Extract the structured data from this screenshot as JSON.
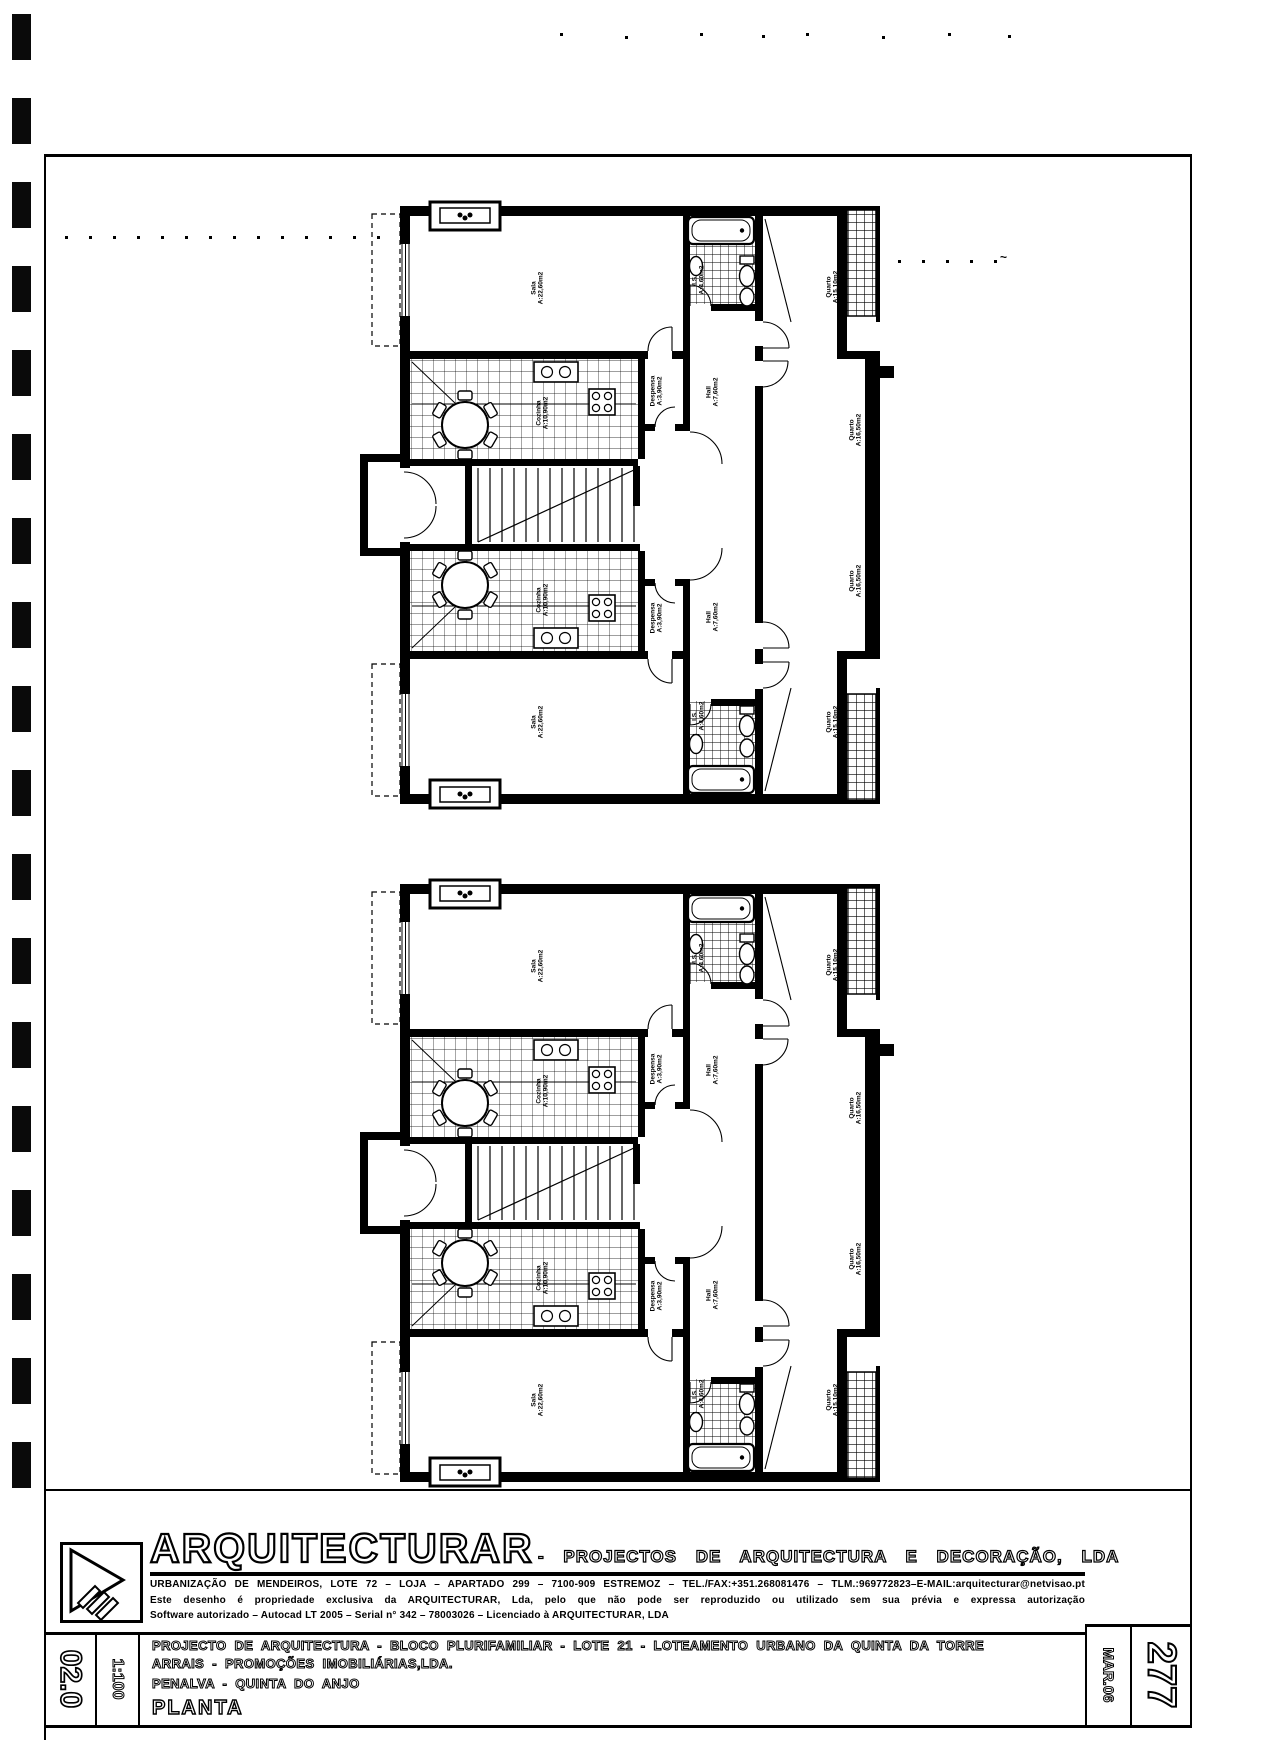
{
  "title_block": {
    "firm": "ARQUITECTURAR",
    "firm_suffix": "- PROJECTOS DE ARQUITECTURA E DECORAÇÃO, LDA",
    "address": "URBANIZAÇÃO DE MENDEIROS, LOTE 72 – LOJA – APARTADO 299 – 7100-909 ESTREMOZ – TEL./FAX:+351.268081476 – TLM.:969772823–E-MAIL:arquitecturar@netvisao.pt",
    "notice": "Este desenho é propriedade exclusiva da ARQUITECTURAR, Lda, pelo que não pode ser reproduzido ou utilizado sem sua prévia e expressa autorização",
    "software": "Software autorizado – Autocad LT 2005 – Serial n° 342 – 78003026 – Licenciado à ARQUITECTURAR, LDA",
    "project_line": "PROJECTO DE ARQUITECTURA - BLOCO PLURIFAMILIAR - LOTE 21 - LOTEAMENTO URBANO DA QUINTA DA TORRE",
    "client_line": "ARRAIS - PROMOÇÕES IMOBILIÁRIAS,LDA.",
    "location_line": "PENALVA - QUINTA DO ANJO",
    "drawing_title": "PLANTA",
    "sheet_number": "02.0",
    "scale": "1:100",
    "page_number": "277",
    "date": "MAR.06"
  },
  "rooms": [
    {
      "name": "Sala",
      "area": "A:22,60m2"
    },
    {
      "name": "I.S.",
      "area": "A:4,60m2"
    },
    {
      "name": "Quarto",
      "area": "A:15,10m2"
    },
    {
      "name": "Cozinha",
      "area": "A:10,90m2"
    },
    {
      "name": "Despensa",
      "area": "A:3,90m2"
    },
    {
      "name": "Hall",
      "area": "A:7,60m2"
    },
    {
      "name": "Quarto",
      "area": "A:16,50m2"
    },
    {
      "name": "Quarto",
      "area": "A:16,50m2"
    },
    {
      "name": "Cozinha",
      "area": "A:10,90m2"
    },
    {
      "name": "Despensa",
      "area": "A:3,90m2"
    },
    {
      "name": "Hall",
      "area": "A:7,60m2"
    },
    {
      "name": "Sala",
      "area": "A:22,60m2"
    },
    {
      "name": "I.S.",
      "area": "A:4,60m2"
    },
    {
      "name": "Quarto",
      "area": "A:15,10m2"
    }
  ],
  "artifacts": {
    "stray_mark": "~"
  }
}
